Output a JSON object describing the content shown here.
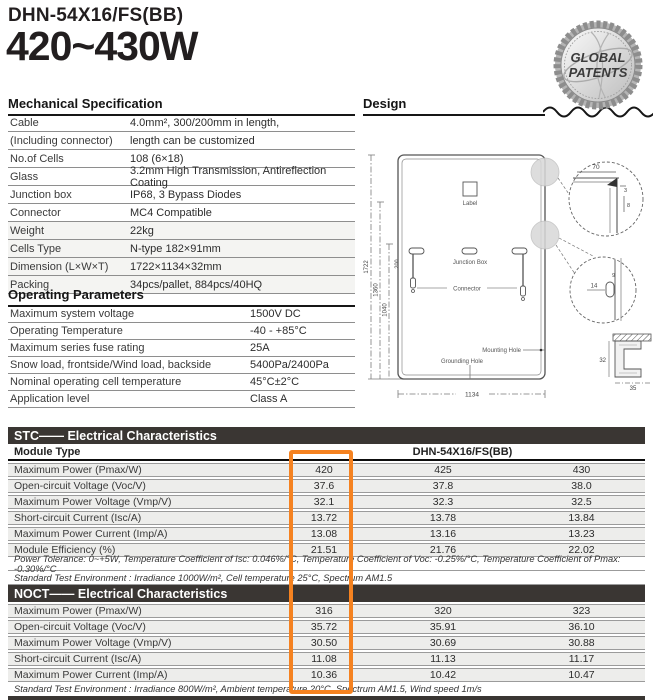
{
  "header": {
    "model": "DHN-54X16/FS(BB)",
    "power_range": "420~430W",
    "badge_line1": "GLOBAL",
    "badge_line2": "PATENTS"
  },
  "mechanical": {
    "title": "Mechanical Specification",
    "rows": [
      {
        "label": "Cable",
        "value": "4.0mm², 300/200mm in length,"
      },
      {
        "label": "(Including connector)",
        "value": "length can be customized"
      },
      {
        "label": "No.of Cells",
        "value": "108 (6×18)"
      },
      {
        "label": "Glass",
        "value": "3.2mm High Transmission, Antireflection Coating"
      },
      {
        "label": "Junction box",
        "value": "IP68, 3 Bypass Diodes"
      },
      {
        "label": "Connector",
        "value": "MC4 Compatible"
      },
      {
        "label": "Weight",
        "value": "22kg"
      },
      {
        "label": "Cells Type",
        "value": "N-type 182×91mm"
      },
      {
        "label": "Dimension (L×W×T)",
        "value": "1722×1134×32mm"
      },
      {
        "label": "Packing",
        "value": "34pcs/pallet, 884pcs/40HQ"
      }
    ]
  },
  "operating": {
    "title": "Operating Parameters",
    "rows": [
      {
        "label": "Maximum system voltage",
        "value": "1500V DC"
      },
      {
        "label": "Operating Temperature",
        "value": "-40 - +85°C"
      },
      {
        "label": "Maximum series fuse rating",
        "value": "25A"
      },
      {
        "label": "Snow load, frontside/Wind load, backside",
        "value": "5400Pa/2400Pa"
      },
      {
        "label": "Nominal operating cell temperature",
        "value": "45°C±2°C"
      },
      {
        "label": "Application level",
        "value": "Class A"
      }
    ]
  },
  "design": {
    "title": "Design",
    "panel_label": "Label",
    "junction_box": "Junction Box",
    "connector": "Connector",
    "mounting_hole": "Mounting Hole",
    "grounding_hole": "Grounding Hole",
    "dims": {
      "total_height": "1722",
      "h1360": "1360",
      "h1040": "1040",
      "h200": "200",
      "h160": "160",
      "width": "1134",
      "corner_width": "70",
      "corner_3": "3",
      "corner_8": "8",
      "hole_14": "14",
      "hole_9": "9",
      "frame_32": "32",
      "frame_35": "35"
    }
  },
  "stc": {
    "bar_label": "STC—— Electrical Characteristics",
    "module_type_label": "Module Type",
    "module_type_value": "DHN-54X16/FS(BB)",
    "rows": [
      {
        "label": "Maximum Power (Pmax/W)",
        "values": [
          "420",
          "425",
          "430"
        ]
      },
      {
        "label": "Open-circuit Voltage (Voc/V)",
        "values": [
          "37.6",
          "37.8",
          "38.0"
        ]
      },
      {
        "label": "Maximum Power Voltage (Vmp/V)",
        "values": [
          "32.1",
          "32.3",
          "32.5"
        ]
      },
      {
        "label": "Short-circuit Current (Isc/A)",
        "values": [
          "13.72",
          "13.78",
          "13.84"
        ]
      },
      {
        "label": "Maximum Power Current (Imp/A)",
        "values": [
          "13.08",
          "13.16",
          "13.23"
        ]
      },
      {
        "label": "Module Efficiency (%)",
        "values": [
          "21.51",
          "21.76",
          "22.02"
        ]
      }
    ],
    "footnote1": "Power Tolerance: 0~+5W, Temperature Coefficient of Isc: 0.046%/°C, Temperature Coefficient of Voc: -0.25%/°C, Temperature Coefficient of Pmax: -0.30%/°C",
    "footnote2": "Standard Test Environment : Irradiance 1000W/m², Cell temperature 25°C, Spectrum AM1.5"
  },
  "noct": {
    "bar_label": "NOCT—— Electrical Characteristics",
    "rows": [
      {
        "label": "Maximum Power (Pmax/W)",
        "values": [
          "316",
          "320",
          "323"
        ]
      },
      {
        "label": "Open-circuit Voltage (Voc/V)",
        "values": [
          "35.72",
          "35.91",
          "36.10"
        ]
      },
      {
        "label": "Maximum Power Voltage (Vmp/V)",
        "values": [
          "30.50",
          "30.69",
          "30.88"
        ]
      },
      {
        "label": "Short-circuit Current (Isc/A)",
        "values": [
          "11.08",
          "11.13",
          "11.17"
        ]
      },
      {
        "label": "Maximum Power Current (Imp/A)",
        "values": [
          "10.36",
          "10.42",
          "10.47"
        ]
      }
    ],
    "footnote": "Standard Test Environment : Irradiance 800W/m², Ambient temperature 20°C, Spectrum AM1.5, Wind speed 1m/s"
  },
  "colors": {
    "accent_orange": "#f58220",
    "bar_dark": "#3a3633"
  }
}
